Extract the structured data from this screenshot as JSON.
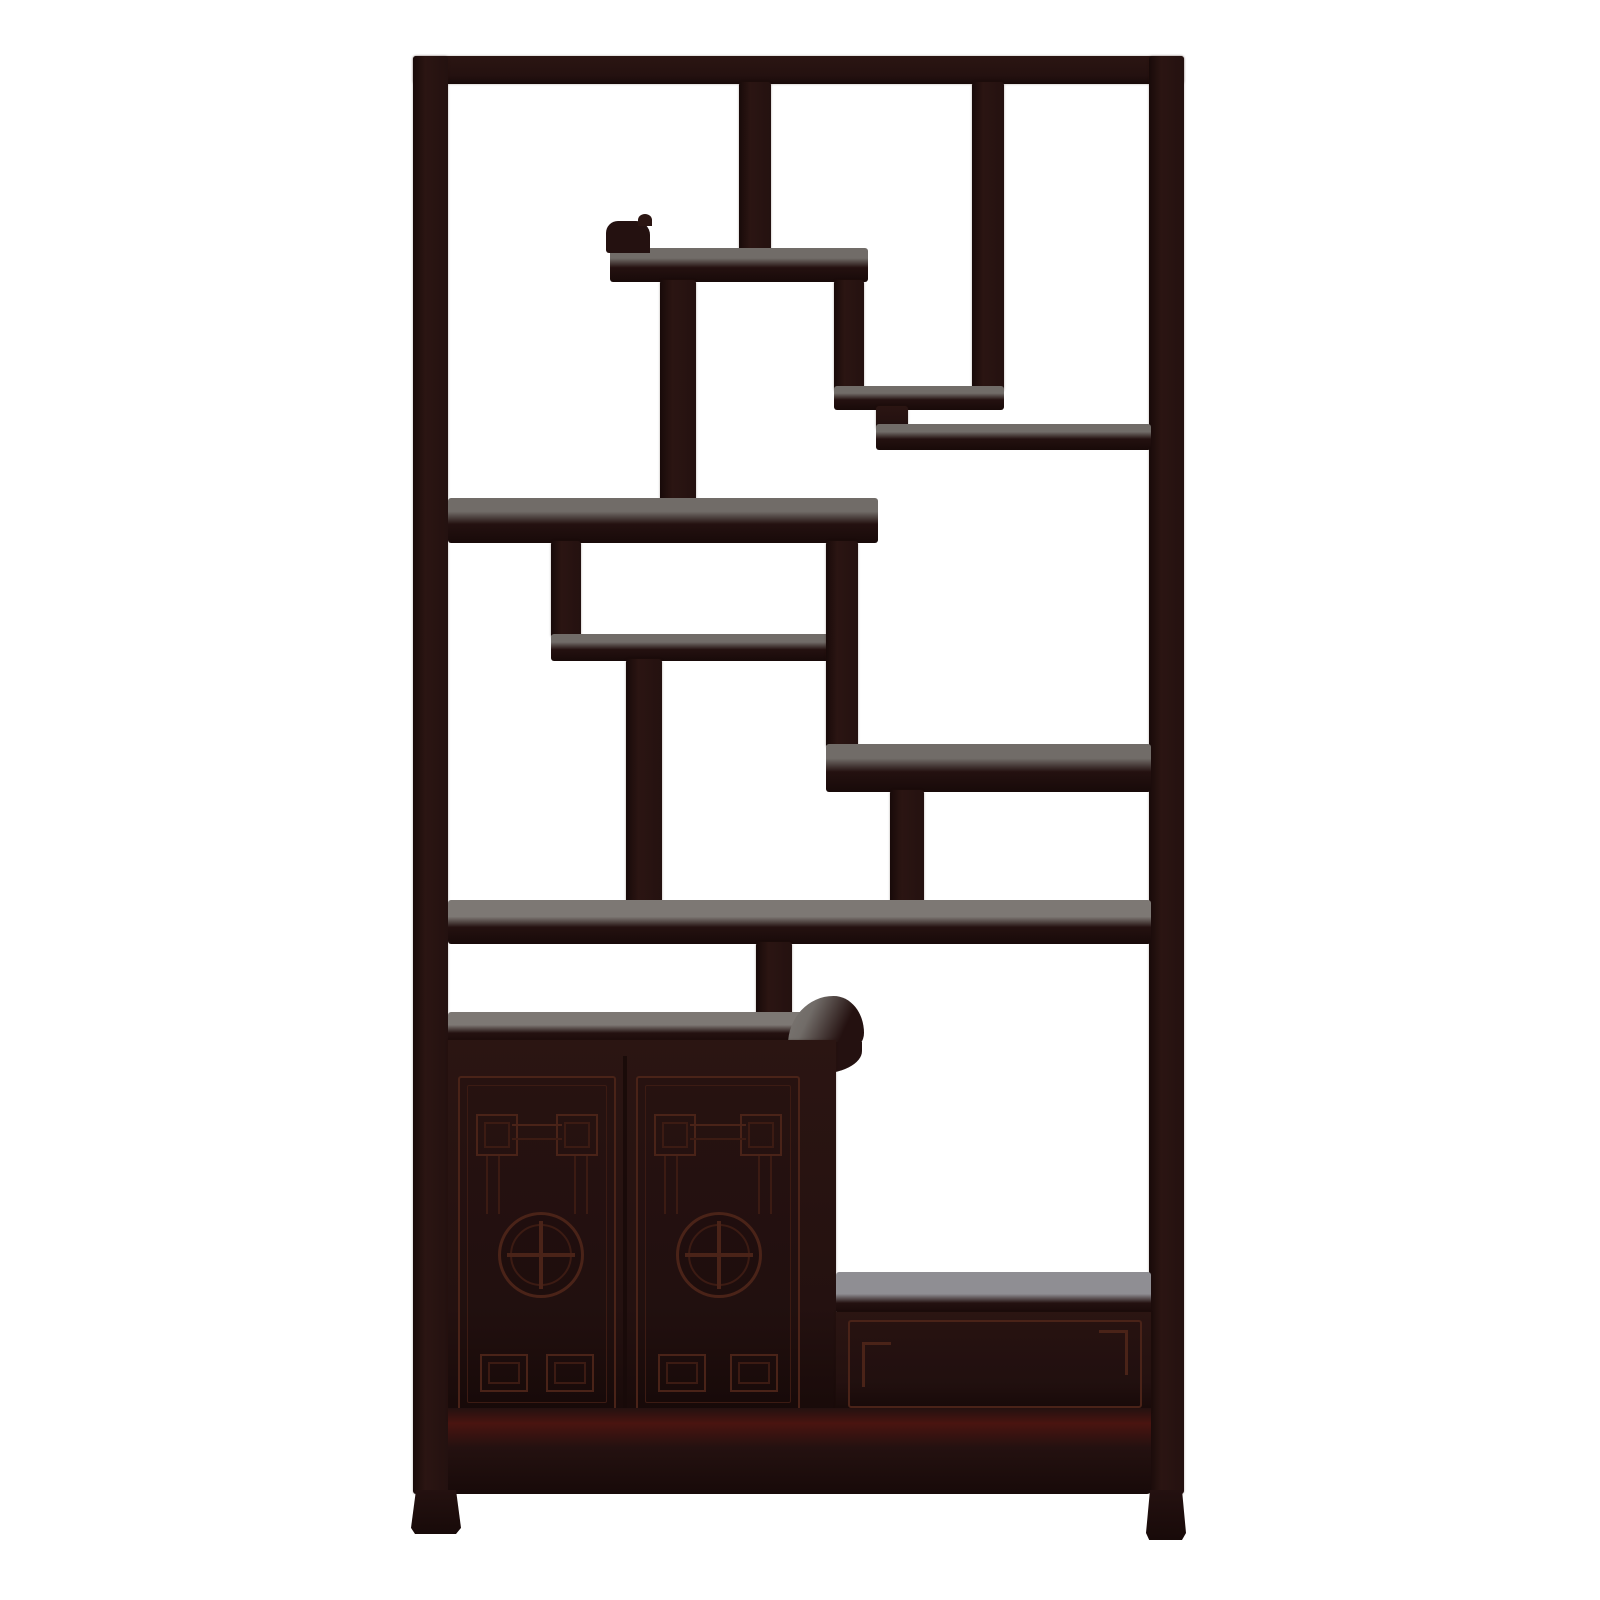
{
  "scene": {
    "type": "product-photograph",
    "subject": "Chinese dark rosewood zen curio display shelf with asymmetric compartments, two carved doors and a drawer",
    "background": "plain white studio background",
    "orientation": "front view, tall rectangular cabinet"
  },
  "colors": {
    "bg": "#ffffff",
    "wood": "#241110",
    "wood2": "#2b1512",
    "deep": "#180a09",
    "maroon": "#4a1410",
    "carve": "#4a2318",
    "carvedim": "#3c1b13",
    "hl": "#716c68",
    "hlwarm": "#7d7874",
    "hllight": "#8f8e93"
  },
  "furniture": {
    "sections": [
      "outer frame with top rail and side posts",
      "upper lattice of staggered open display compartments",
      "scroll-ended floating shelves",
      "two-door cabinet with carved fret corners and shou medallions",
      "side drawer with incised panel",
      "bottom apron and short splayed feet"
    ],
    "compartment_count": 10,
    "door_count": 2,
    "drawer_count": 1,
    "medallion_motif": "circular shou longevity symbol",
    "corner_motif": "angular key-fret (meander) carving"
  }
}
